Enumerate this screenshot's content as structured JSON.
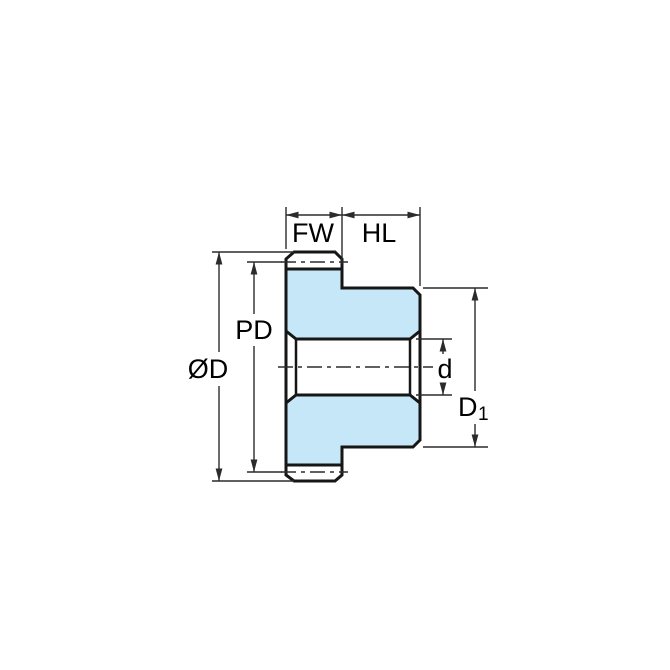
{
  "diagram": {
    "type": "technical-drawing",
    "description": "Spur gear side cross-section with dimension callouts",
    "colors": {
      "part_fill": "#c5e7f8",
      "bore_fill": "#ffffff",
      "outline": "#161616",
      "dimension_lines": "#2b2b2b",
      "background": "#ffffff"
    },
    "labels": {
      "face_width": "FW",
      "hub_length": "HL",
      "pitch_diameter": "PD",
      "outside_diameter": "ØD",
      "bore_diameter": "d",
      "hub_diameter_main": "D",
      "hub_diameter_sub": "1"
    }
  }
}
